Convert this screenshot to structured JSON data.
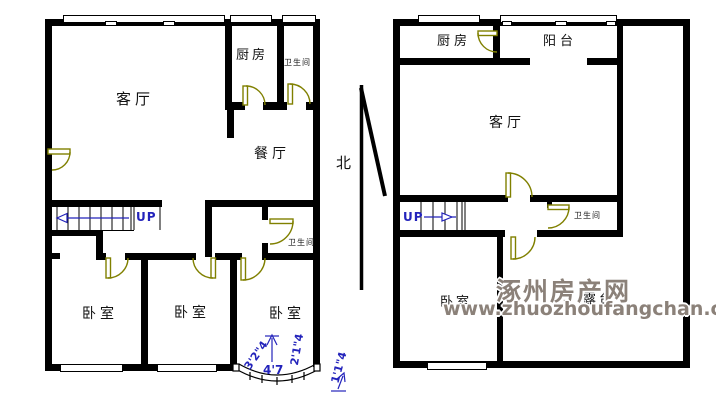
{
  "colors": {
    "wall": "#000000",
    "door": "#808000",
    "annotation": "#2323bb",
    "watermark": "#8b8179"
  },
  "north": {
    "label": "北"
  },
  "watermark": {
    "title": "涿州房产网",
    "url": "www.zhuozhoufangchan.com"
  },
  "floor1": {
    "living": "客厅",
    "kitchen": "厨房",
    "bath_top": "卫生间",
    "dining": "餐厅",
    "bath_mid": "卫生间",
    "bedroom_left": "卧室",
    "bedroom_mid": "卧室",
    "bedroom_right": "卧室",
    "stairs_label": "UP",
    "dims": {
      "left": "3'2\"4",
      "bottom": "4'7",
      "right": "2'1\"4",
      "outer": "1'1\"4"
    }
  },
  "floor2": {
    "kitchen": "厨房",
    "balcony": "阳台",
    "living": "客厅",
    "bath": "卫生间",
    "bedroom": "卧室",
    "terrace": "露台",
    "stairs_label": "UP"
  }
}
